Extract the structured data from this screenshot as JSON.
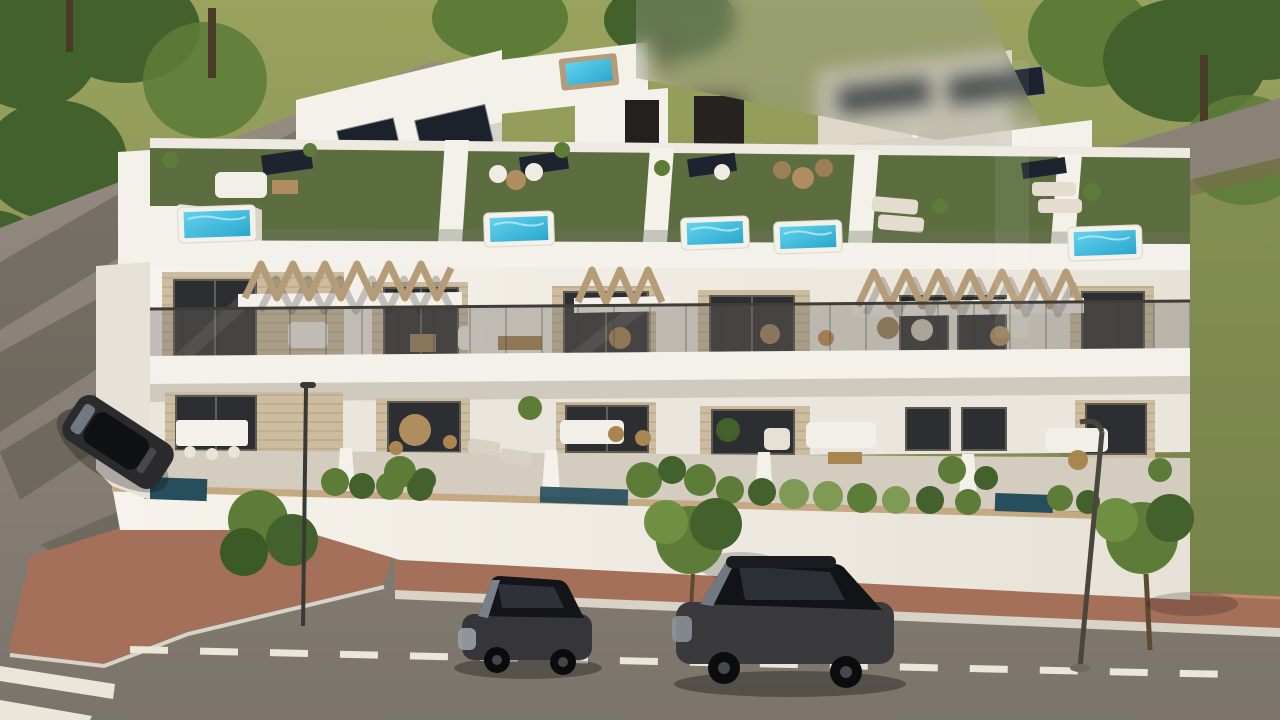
{
  "meta": {
    "title": "Aerial 3D architectural render of a row of modern white townhouses with rooftop pool terraces, balconies, garden street and parked cars",
    "type": "architectural-visualization",
    "time_of_day": "daytime",
    "text_visible": "none"
  },
  "watermark": {
    "present": true,
    "legible": false,
    "location": "top-center blurred patch"
  },
  "palette": {
    "grass": "#8a9254",
    "grass_dark": "#6f7d45",
    "foliage": "#42612c",
    "foliage2": "#5d7c38",
    "road": "#8a8177",
    "road_dark": "#746d64",
    "brick": "#a5705a",
    "curb": "#d9d2c6",
    "marking": "#eae6da",
    "building_white": "#f4f1ea",
    "building_shade": "#d9d4c9",
    "stone": "#cdbda0",
    "glass_dark": "#2c2e31",
    "turf": "#5c6e40",
    "pool_water": "#49c4e6",
    "pool_dark": "#274e5c",
    "wood": "#b59c78",
    "tile": "#d3ccbf",
    "car_dark": "#2b2b2e",
    "shadow": "#32322a"
  },
  "scene": {
    "townhouse_units": 5,
    "rooftop_spa_pools": 5,
    "ground_plunge_pools": 3,
    "rooftop_hot_tub_rear": 1,
    "solar_panel_groups": 9,
    "wooden_pergolas": 3,
    "parked_cars": 3,
    "street_lamps": 2,
    "crosswalk_stripes": 2,
    "lane_dashes": 16,
    "street_trees": 3
  }
}
